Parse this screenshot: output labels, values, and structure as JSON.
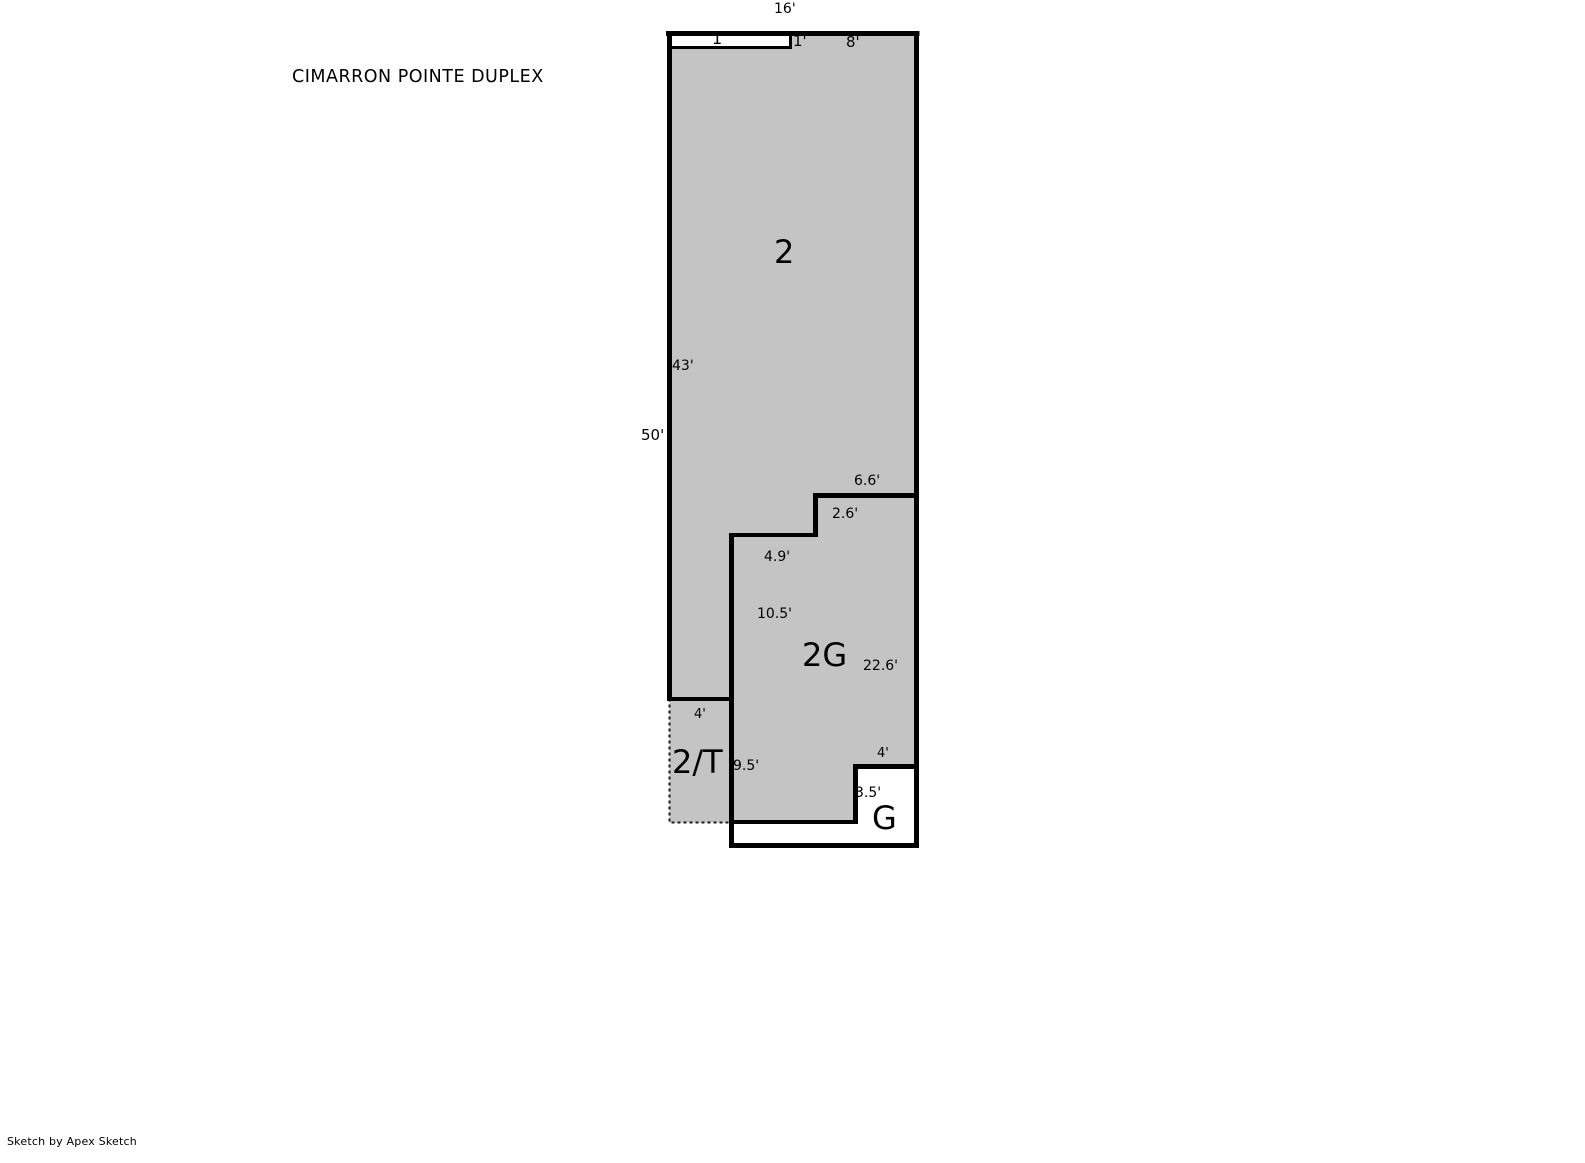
{
  "page": {
    "title": "CIMARRON POINTE DUPLEX",
    "credit": "Sketch by Apex Sketch"
  },
  "colors": {
    "wall": "#000000",
    "area_fill": "#c4c4c4",
    "background": "#ffffff",
    "dashed_outline": "#1a1a1a"
  },
  "areas": {
    "upper": {
      "label": "2"
    },
    "garage_level": {
      "label": "2G"
    },
    "terrace": {
      "label": "2/T"
    },
    "garage": {
      "label": "G"
    },
    "strip": {
      "label": "1"
    }
  },
  "dimensions": {
    "top_width": "16'",
    "strip_height": "1'",
    "top_right_segment": "8'",
    "left_upper": "43'",
    "left_overall": "50'",
    "step_upper_width": "6.6'",
    "step_height": "2.6'",
    "step_lower_width": "4.9'",
    "mid_wall": "10.5'",
    "right_lower": "22.6'",
    "terrace_width": "4'",
    "terrace_height": "9.5'",
    "garage_notch_width": "4'",
    "garage_notch_height": "3.5'"
  }
}
